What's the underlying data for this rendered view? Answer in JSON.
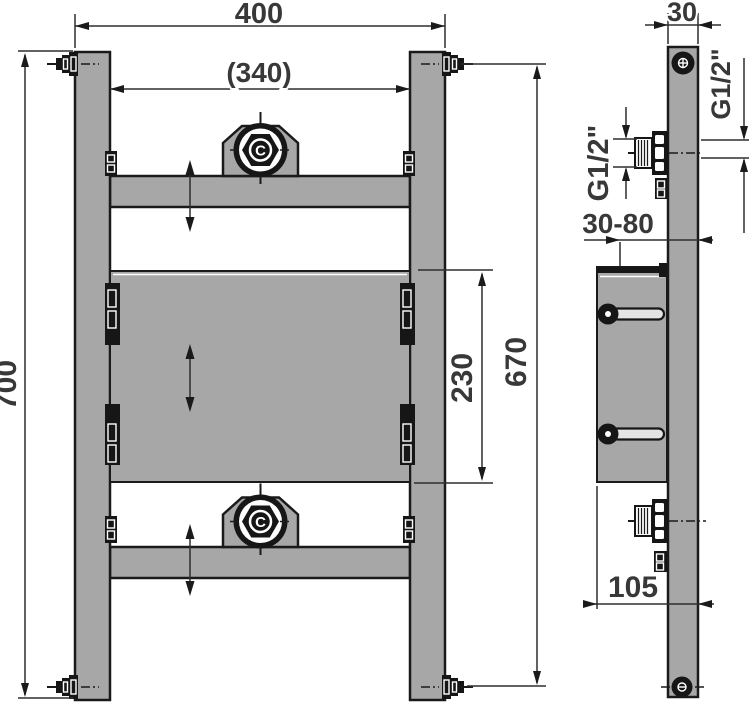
{
  "drawing": {
    "background_color": "#ffffff",
    "frame_color": "#a7a7a7",
    "line_color": "#1a1a1a",
    "front_view": {
      "dim_overall_width": "400",
      "dim_inner_width": "(340)",
      "dim_overall_height": "700",
      "dim_panel_height": "230",
      "dim_anchor_spacing": "670",
      "nut_logo": "C"
    },
    "side_view": {
      "dim_profile_depth": "30",
      "dim_thread_front": "G1/2\"",
      "dim_thread_rear": "G1/2\"",
      "dim_wall_offset_range": "30-80",
      "dim_mount_depth": "105"
    }
  }
}
